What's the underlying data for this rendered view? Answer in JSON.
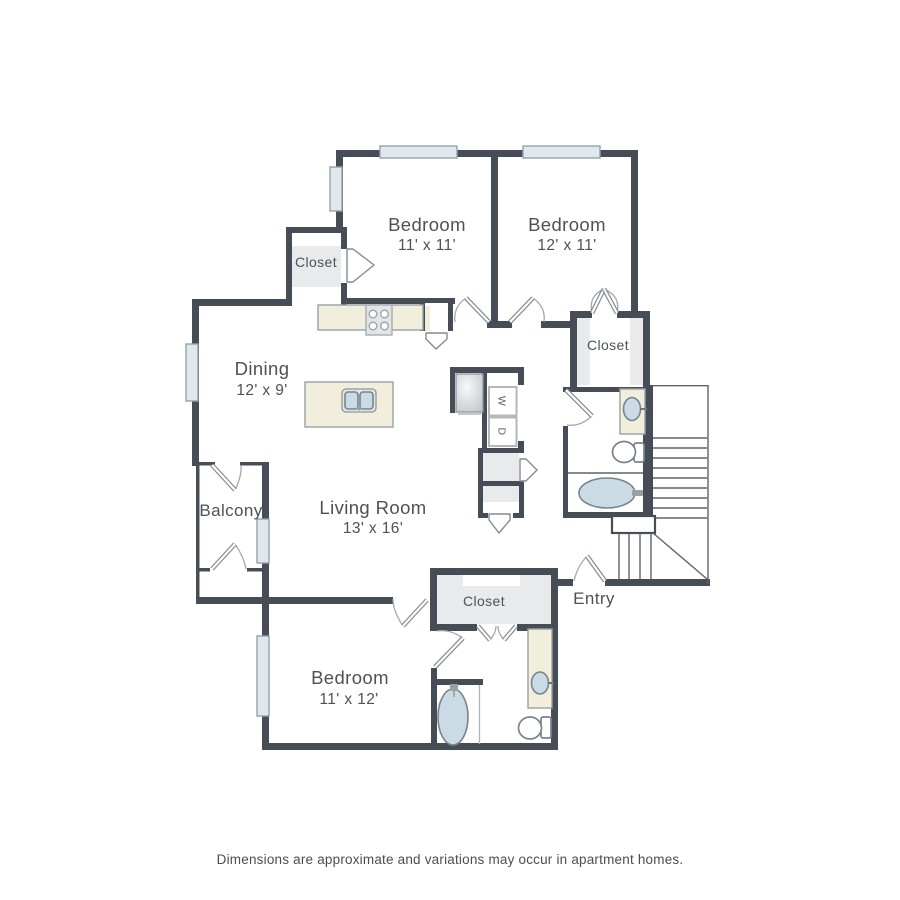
{
  "floorplan": {
    "rooms": {
      "bedroom1": {
        "name": "Bedroom",
        "dims": "11' x 11'"
      },
      "bedroom2": {
        "name": "Bedroom",
        "dims": "12' x 11'"
      },
      "dining": {
        "name": "Dining",
        "dims": "12' x 9'"
      },
      "living": {
        "name": "Living Room",
        "dims": "13' x 16'"
      },
      "bedroom3": {
        "name": "Bedroom",
        "dims": "11' x 12'"
      },
      "balcony": {
        "name": "Balcony"
      },
      "entry": {
        "name": "Entry"
      }
    },
    "closets": {
      "top_left": "Closet",
      "right": "Closet",
      "bottom": "Closet"
    },
    "laundry": {
      "washer": "W",
      "dryer": "D"
    },
    "colors": {
      "wall": "#474d57",
      "window_fill": "#e0e8ed",
      "counter_cream": "#f1eedb",
      "fixture_blue": "#cbdbe5",
      "closet_gray": "#e9eaec"
    },
    "footer": {
      "disclaimer": "Dimensions are approximate and variations may occur in apartment homes."
    }
  }
}
